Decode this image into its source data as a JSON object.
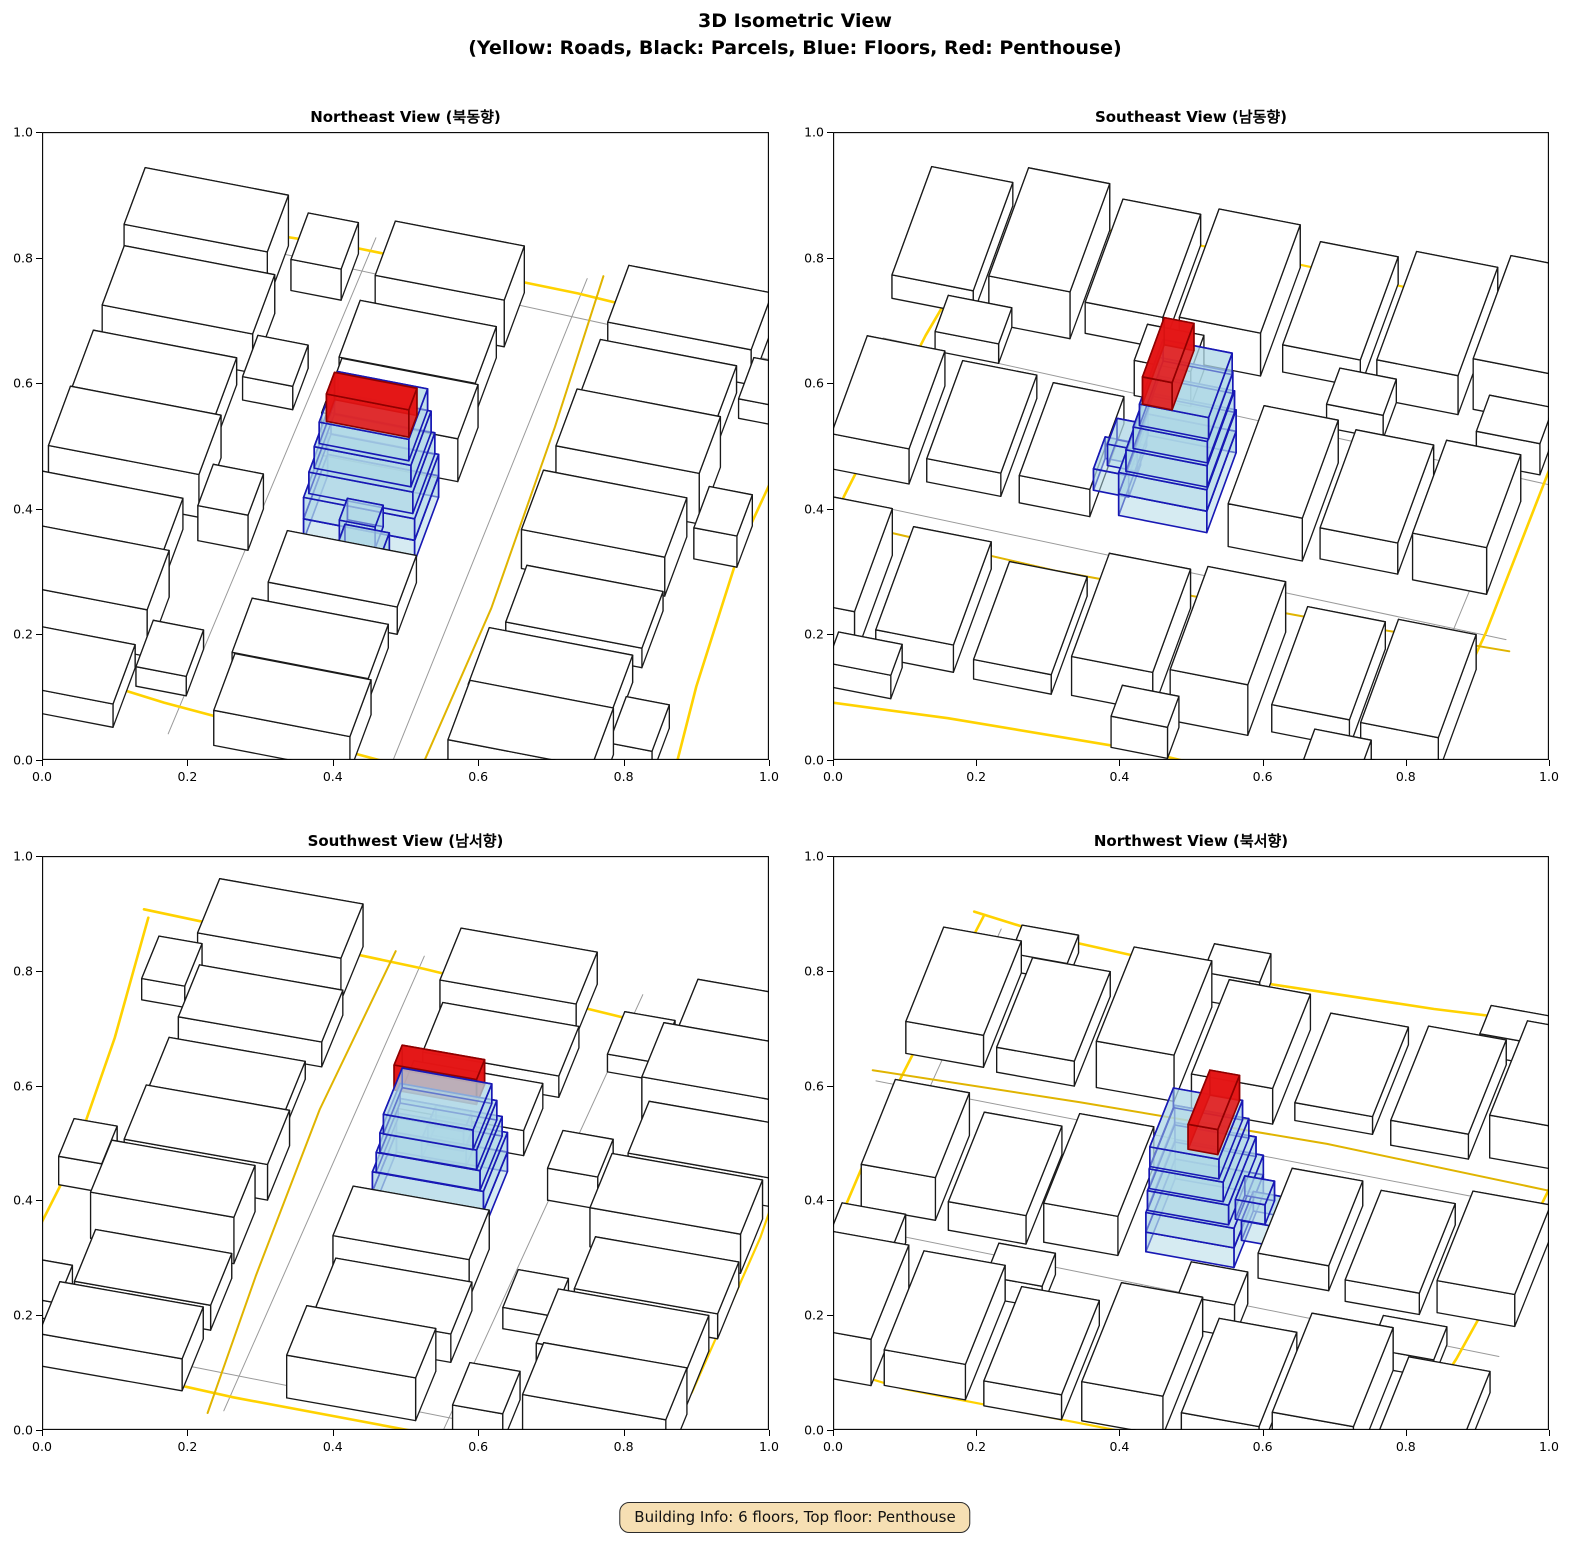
{
  "figure": {
    "title_line1": "3D Isometric View",
    "title_line2": "(Yellow: Roads, Black: Parcels, Blue: Floors, Red: Penthouse)"
  },
  "badge": {
    "text": "Building Info: 6 floors, Top floor: Penthouse"
  },
  "axis": {
    "ticks": [
      "0.0",
      "0.2",
      "0.4",
      "0.6",
      "0.8",
      "1.0"
    ]
  },
  "subplots": [
    {
      "key": "northeast",
      "title": "Northeast View (북동향)",
      "azimuth_deg": 5
    },
    {
      "key": "southeast",
      "title": "Southeast View (남동향)",
      "azimuth_deg": 95
    },
    {
      "key": "southwest",
      "title": "Southwest View (남서향)",
      "azimuth_deg": 185
    },
    {
      "key": "northwest",
      "title": "Northwest View (북서향)",
      "azimuth_deg": 275
    }
  ],
  "colors": {
    "road": "#FFD200",
    "road_minor": "#E0B400",
    "boundary_gray": "#9a9a9a",
    "parcel_fill": "#ffffff",
    "parcel_edge": "#1a1a1a",
    "floor_fill": "#ADD8E6",
    "floor_edge": "#1818B4",
    "penthouse_fill": "#E41414",
    "penthouse_edge": "#8F0000",
    "badge_bg": "#F6DFB3",
    "axis_line": "#000000"
  },
  "chart_data": {
    "type": "3d-isometric-city",
    "title": "3D Isometric View",
    "subtitle": "(Yellow: Roads, Black: Parcels, Blue: Floors, Red: Penthouse)",
    "views": [
      "Northeast",
      "Southeast",
      "Southwest",
      "Northwest"
    ],
    "axes": {
      "xlim": [
        0,
        1
      ],
      "ylim": [
        0,
        1
      ],
      "tick_step": 0.2,
      "grid": false
    },
    "building": {
      "floors": 6,
      "top_floor": "Penthouse",
      "blue_floors": 5,
      "center": [
        0.46,
        0.47
      ]
    },
    "projection": {
      "scale": 1.02,
      "foreshorten": 0.85,
      "zscale": 0.62,
      "v0": 0.4,
      "tilt_deg": 10
    },
    "scene": {
      "parcels": [
        [
          0.12,
          0.06,
          0.21,
          0.115,
          0.06
        ],
        [
          0.13,
          0.2,
          0.21,
          0.115,
          0.12
        ],
        [
          0.12,
          0.33,
          0.2,
          0.11,
          0.08
        ],
        [
          0.13,
          0.47,
          0.21,
          0.115,
          0.11
        ],
        [
          0.12,
          0.61,
          0.2,
          0.11,
          0.07
        ],
        [
          0.13,
          0.75,
          0.21,
          0.115,
          0.1
        ],
        [
          0.12,
          0.88,
          0.2,
          0.11,
          0.13
        ],
        [
          0.27,
          0.13,
          0.07,
          0.09,
          0.05
        ],
        [
          0.28,
          0.41,
          0.07,
          0.08,
          0.09
        ],
        [
          0.27,
          0.68,
          0.07,
          0.08,
          0.06
        ],
        [
          0.28,
          0.9,
          0.07,
          0.09,
          0.08
        ],
        [
          0.46,
          0.06,
          0.19,
          0.11,
          0.09
        ],
        [
          0.45,
          0.19,
          0.19,
          0.105,
          0.06
        ],
        [
          0.46,
          0.32,
          0.18,
          0.1,
          0.07
        ],
        [
          0.46,
          0.62,
          0.19,
          0.105,
          0.11
        ],
        [
          0.45,
          0.75,
          0.19,
          0.11,
          0.08
        ],
        [
          0.46,
          0.88,
          0.18,
          0.105,
          0.12
        ],
        [
          0.79,
          0.07,
          0.2,
          0.115,
          0.12
        ],
        [
          0.78,
          0.21,
          0.2,
          0.11,
          0.07
        ],
        [
          0.79,
          0.35,
          0.19,
          0.11,
          0.05
        ],
        [
          0.78,
          0.49,
          0.2,
          0.115,
          0.1
        ],
        [
          0.79,
          0.63,
          0.2,
          0.11,
          0.13
        ],
        [
          0.78,
          0.77,
          0.19,
          0.11,
          0.07
        ],
        [
          0.79,
          0.9,
          0.2,
          0.11,
          0.09
        ],
        [
          0.92,
          0.15,
          0.06,
          0.09,
          0.06
        ],
        [
          0.93,
          0.55,
          0.06,
          0.08,
          0.08
        ],
        [
          0.92,
          0.82,
          0.06,
          0.08,
          0.05
        ]
      ],
      "floors": [
        [
          0.0,
          0.0,
          0.155,
          0.125,
          0.0,
          0.055
        ],
        [
          0.01,
          -0.083,
          0.062,
          0.05,
          0.0,
          0.055
        ],
        [
          0.0,
          0.0,
          0.155,
          0.125,
          0.055,
          0.11
        ],
        [
          0.005,
          -0.07,
          0.05,
          0.042,
          0.055,
          0.11
        ],
        [
          0.0,
          0.004,
          0.145,
          0.115,
          0.11,
          0.165
        ],
        [
          0.0,
          0.008,
          0.135,
          0.105,
          0.165,
          0.22
        ],
        [
          0.0,
          0.012,
          0.125,
          0.098,
          0.22,
          0.275
        ]
      ],
      "penthouse": [
        [
          0.004,
          -0.012,
          0.115,
          0.042,
          0.275,
          0.345
        ]
      ],
      "roads": [
        {
          "name": "north-road",
          "width": 2.6,
          "points": [
            [
              0.01,
              0.94
            ],
            [
              0.3,
              0.955
            ],
            [
              0.62,
              0.95
            ],
            [
              0.85,
              0.935
            ],
            [
              0.99,
              0.925
            ]
          ]
        },
        {
          "name": "east-road",
          "width": 2.6,
          "points": [
            [
              0.985,
              0.03
            ],
            [
              0.965,
              0.28
            ],
            [
              0.955,
              0.55
            ],
            [
              0.97,
              0.8
            ],
            [
              0.995,
              0.94
            ]
          ]
        },
        {
          "name": "south-road",
          "width": 2.6,
          "points": [
            [
              0.005,
              0.105
            ],
            [
              0.28,
              0.065
            ],
            [
              0.6,
              0.035
            ],
            [
              0.995,
              0.015
            ]
          ]
        },
        {
          "name": "west-road",
          "width": 2.2,
          "points": [
            [
              0.03,
              0.12
            ],
            [
              0.018,
              0.45
            ],
            [
              0.025,
              0.78
            ],
            [
              0.05,
              0.93
            ]
          ]
        },
        {
          "name": "mid-street",
          "width": 2.0,
          "points": [
            [
              0.645,
              0.01
            ],
            [
              0.66,
              0.35
            ],
            [
              0.655,
              0.7
            ],
            [
              0.645,
              0.99
            ]
          ]
        }
      ],
      "gray_lines": [
        {
          "points": [
            [
              0.3,
              0.01
            ],
            [
              0.33,
              0.98
            ]
          ]
        },
        {
          "points": [
            [
              0.605,
              0.01
            ],
            [
              0.625,
              0.98
            ]
          ]
        },
        {
          "points": [
            [
              0.01,
              0.925
            ],
            [
              0.97,
              0.895
            ]
          ]
        }
      ]
    }
  },
  "layout_note": "four isometric views of same scene"
}
